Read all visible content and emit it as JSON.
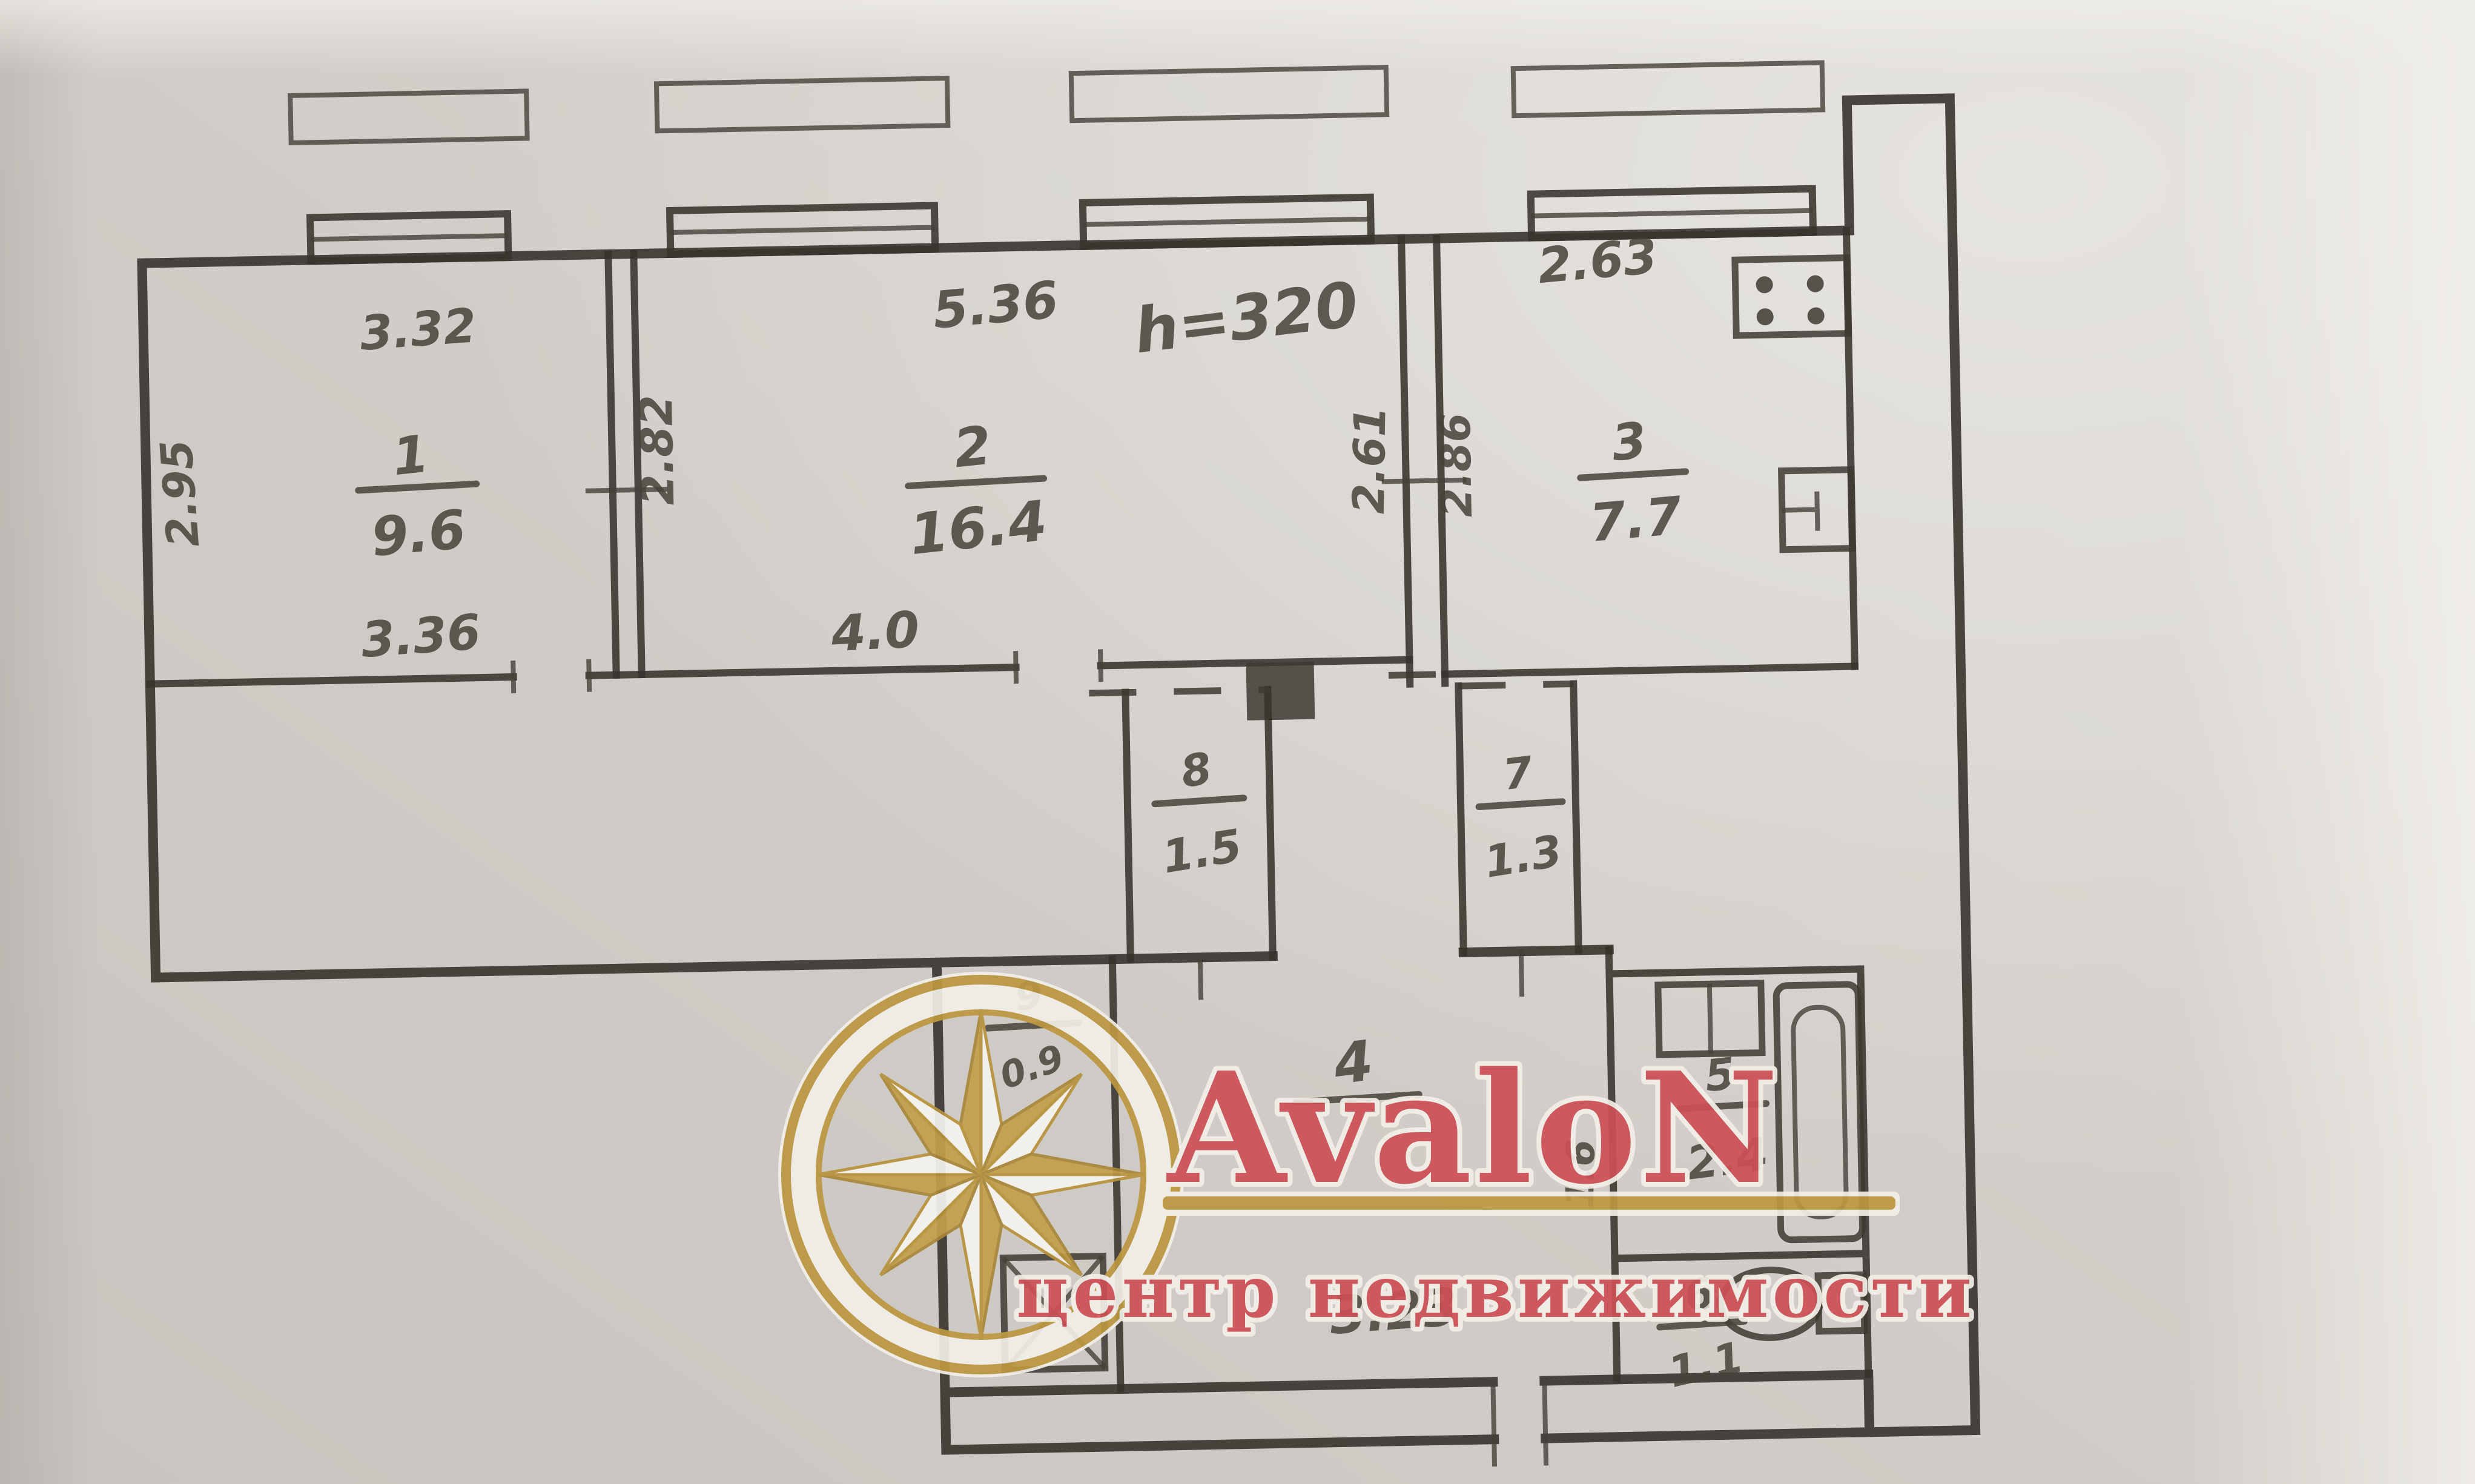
{
  "document": {
    "kind": "scanned apartment floor plan",
    "paper_color": "#d5d1cc",
    "ink_color": "#37332e"
  },
  "plan": {
    "height_note": "h=320",
    "bottom_dimension": "3.23",
    "rooms": {
      "r1": {
        "num": "1",
        "area": "9.6",
        "top": "3.32",
        "bottom": "3.36",
        "left": "2.95"
      },
      "r2": {
        "num": "2",
        "area": "16.4",
        "top": "5.36",
        "bottom": "4.0",
        "left": "2.82",
        "right": "2.61"
      },
      "r3": {
        "num": "3",
        "area": "7.7",
        "top": "2.63",
        "left": "2.86"
      },
      "r4": {
        "num": "4"
      },
      "r5": {
        "num": "5",
        "area": "2.4",
        "left": "1.6"
      },
      "r6": {
        "num": "6",
        "area": "1.1"
      },
      "r7": {
        "num": "7",
        "area": "1.3"
      },
      "r8": {
        "num": "8",
        "area": "1.5"
      },
      "r9": {
        "num": "9",
        "area": "0.9"
      }
    },
    "icons": [
      "window-icon",
      "wardrobe-dashed-front-icon",
      "stove-icon",
      "kitchen-sink-icon",
      "bath-sink-icon",
      "bathtub-icon",
      "toilet-icon",
      "shower-tray-icon"
    ]
  },
  "watermark": {
    "brand": "AvaloN",
    "tagline": "центр недвижимости",
    "accent_color": "#cd5056",
    "gold_color": "#bd9840",
    "logo": "compass-rose"
  }
}
